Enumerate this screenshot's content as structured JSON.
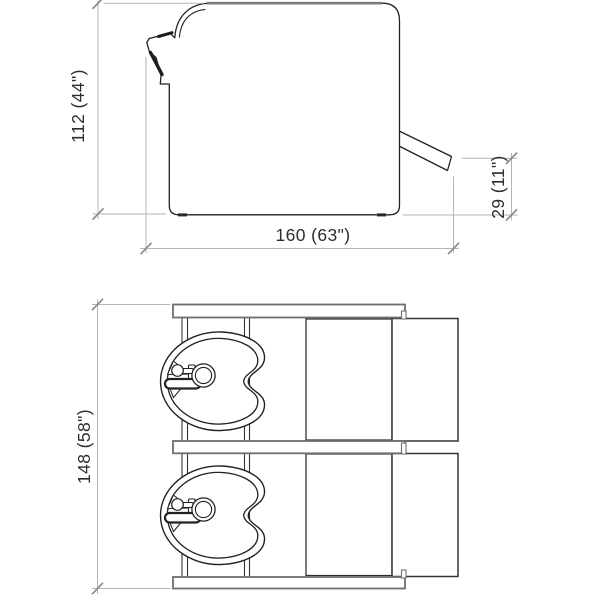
{
  "drawing": {
    "views": {
      "side_view_name": "backwash-unit-side-elevation",
      "plan_view_name": "backwash-unit-top-view",
      "bowl_count": 2
    },
    "dimensions": {
      "side": {
        "height_label": "112  (44\")",
        "width_label": "160  (63\")",
        "footrest_height_label": "29  (11\")"
      },
      "plan": {
        "depth_label": "148  (58\")"
      }
    },
    "colors": {
      "background": "#ffffff",
      "outline": "#222222",
      "panel_edge": "#7c7c7c",
      "dimension_line": "#b5b5b5",
      "tick": "#8a8a8a",
      "label_text": "#2d2d2d"
    }
  }
}
